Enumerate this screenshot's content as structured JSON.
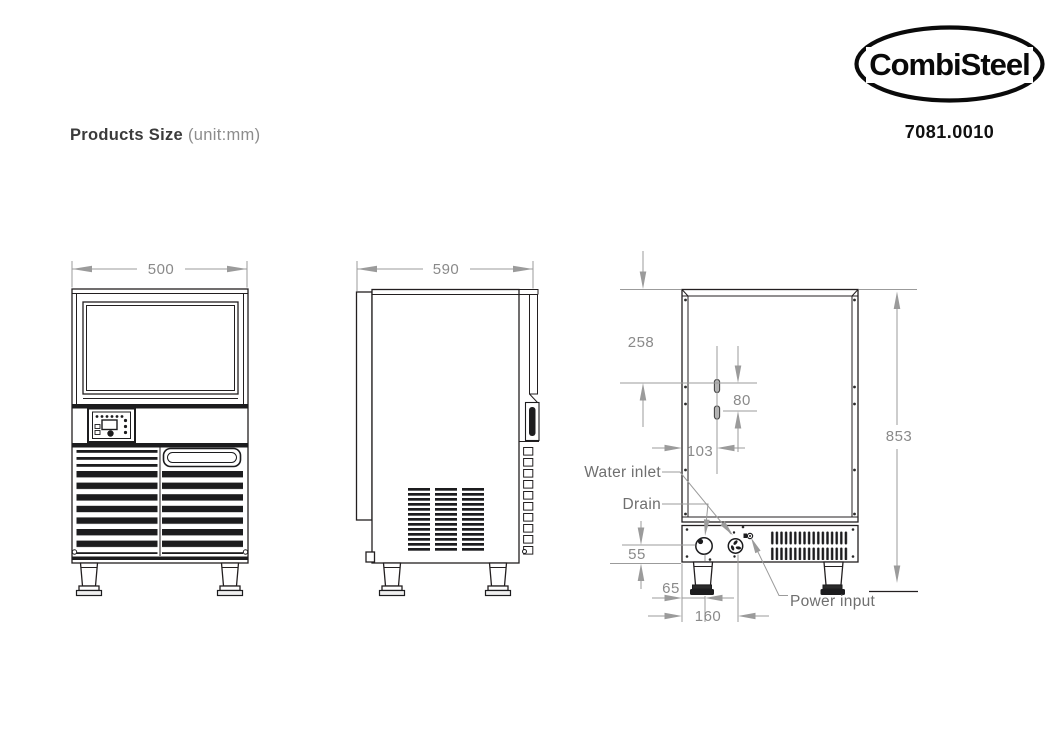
{
  "header": {
    "title": "Products Size",
    "unit_note": "(unit:mm)",
    "brand": "CombiSteel",
    "product_code": "7081.0010"
  },
  "dimensions": {
    "front_width": "500",
    "side_depth": "590",
    "total_height": "853",
    "top_to_inlet_holes": "258",
    "inlet_hole_spacing": "80",
    "inlet_holes_from_edge": "103",
    "drain_center_height": "55",
    "drain_from_edge": "65",
    "water_inlet_from_edge": "160"
  },
  "labels": {
    "water_inlet": "Water inlet",
    "drain": "Drain",
    "power_input": "Power input"
  },
  "colors": {
    "drawing_line": "#231f20",
    "dimension_line": "#9b9b9b",
    "dimension_text": "#8a8a8a",
    "label_text": "#6f6f6f"
  }
}
